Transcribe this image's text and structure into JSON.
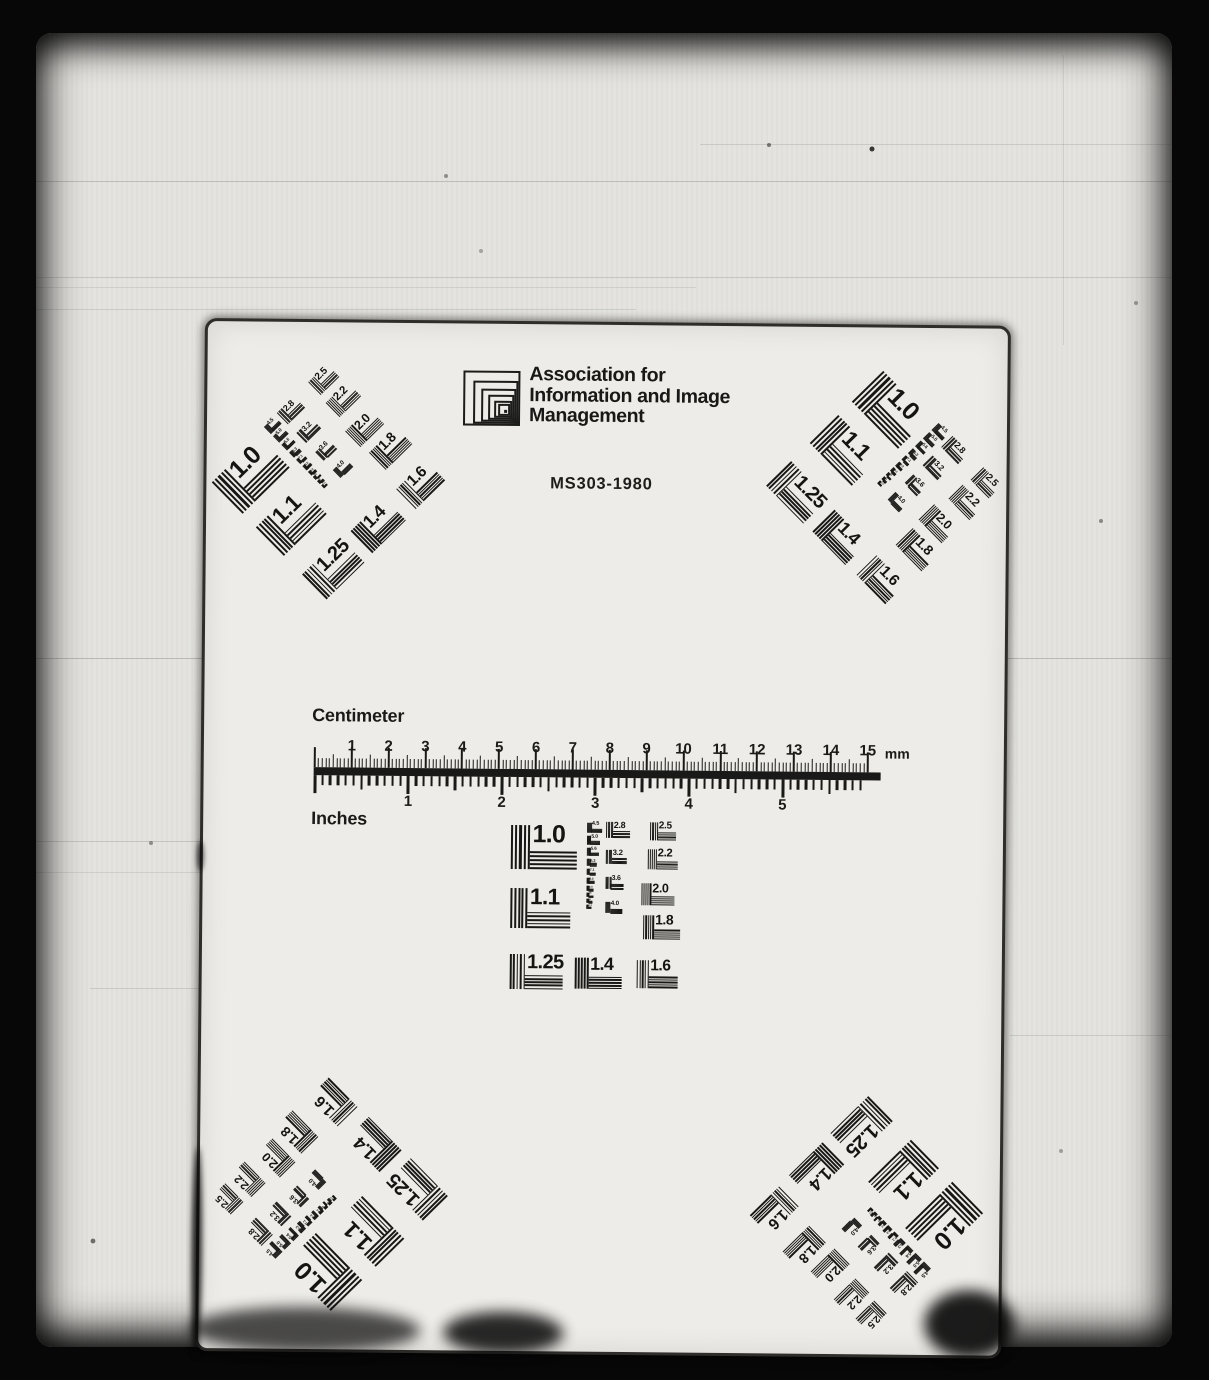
{
  "header": {
    "logo": "aiim-nested-squares-logo",
    "org_lines": [
      "Association for",
      "Information and Image",
      "Management"
    ],
    "standard": "MS303-1980"
  },
  "ruler": {
    "cm_label": "Centimeter",
    "inch_label": "Inches",
    "mm_suffix": "mm",
    "cm_numbers": [
      "1",
      "2",
      "3",
      "4",
      "5",
      "6",
      "7",
      "8",
      "9",
      "10",
      "11",
      "12",
      "13",
      "14",
      "15"
    ],
    "inch_numbers": [
      "1",
      "2",
      "3",
      "4",
      "5"
    ]
  },
  "target": {
    "pattern_values": [
      "1.0",
      "1.1",
      "1.25",
      "1.4",
      "1.6",
      "1.8",
      "2.0",
      "2.2",
      "2.5",
      "2.8",
      "3.2",
      "3.6",
      "4.0",
      "4.5",
      "5.0",
      "5.6",
      "6.3",
      "7.1",
      "8.0",
      "9.0",
      "10",
      "11",
      "12.5"
    ],
    "patterns": [
      {
        "value": "1.0",
        "x": 8,
        "y": 7
      },
      {
        "value": "1.1",
        "x": 8,
        "y": 70
      },
      {
        "value": "1.25",
        "x": 8,
        "y": 136
      },
      {
        "value": "1.4",
        "x": 73,
        "y": 139
      },
      {
        "value": "1.6",
        "x": 135,
        "y": 141
      },
      {
        "value": "2.8",
        "x": 103,
        "y": 3
      },
      {
        "value": "3.2",
        "x": 103,
        "y": 31
      },
      {
        "value": "3.6",
        "x": 103,
        "y": 58
      },
      {
        "value": "4.0",
        "x": 103,
        "y": 83
      },
      {
        "value": "2.5",
        "x": 147,
        "y": 3
      },
      {
        "value": "2.2",
        "x": 145,
        "y": 30
      },
      {
        "value": "2.0",
        "x": 139,
        "y": 64
      },
      {
        "value": "1.8",
        "x": 141,
        "y": 96
      },
      {
        "value": "4.5",
        "x": 84,
        "y": 4
      },
      {
        "value": "5.0",
        "x": 84,
        "y": 17
      },
      {
        "value": "5.6",
        "x": 84,
        "y": 29
      },
      {
        "value": "6.3",
        "x": 84,
        "y": 40
      },
      {
        "value": "7.1",
        "x": 84,
        "y": 50
      },
      {
        "value": "8.0",
        "x": 84,
        "y": 59
      },
      {
        "value": "9.0",
        "x": 84,
        "y": 67
      },
      {
        "value": "10",
        "x": 84,
        "y": 74
      },
      {
        "value": "11",
        "x": 84,
        "y": 80
      },
      {
        "value": "12.5",
        "x": 84,
        "y": 86
      }
    ],
    "clusters": [
      {
        "id": "center",
        "x": 300,
        "y": 494,
        "rotation": 0
      },
      {
        "id": "top-left",
        "x": 32,
        "y": 72,
        "rotation": -45
      },
      {
        "id": "top-right",
        "x": 585,
        "y": 70,
        "rotation": 45
      },
      {
        "id": "bottom-left",
        "x": 43,
        "y": 782,
        "rotation": -135
      },
      {
        "id": "bottom-right",
        "x": 577,
        "y": 794,
        "rotation": 135
      }
    ]
  }
}
